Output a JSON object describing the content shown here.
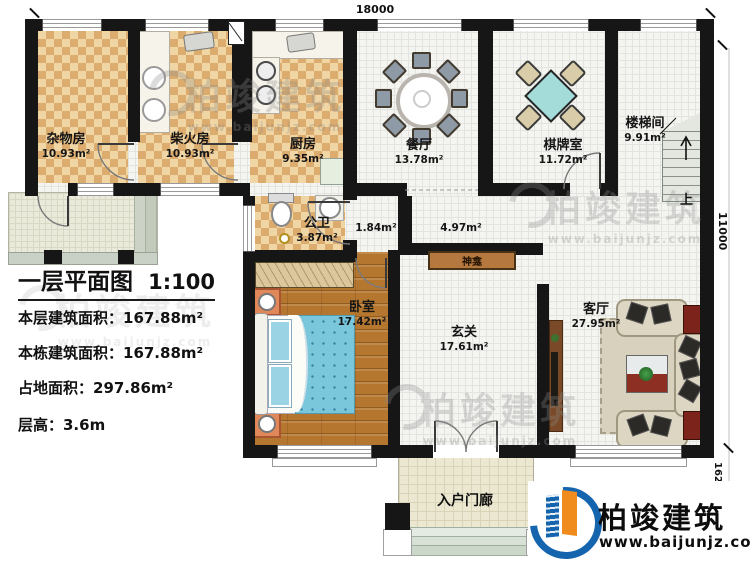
{
  "drawing": {
    "title": "一层平面图",
    "scale": "1:100",
    "info_lines": [
      "本层建筑面积：167.88m²",
      "本栋建筑面积：167.88m²",
      "占地面积：297.86m²",
      "层高：3.6m"
    ]
  },
  "rooms": [
    {
      "name": "杂物房",
      "area": "10.93m²"
    },
    {
      "name": "柴火房",
      "area": "10.93m²"
    },
    {
      "name": "厨房",
      "area": "9.35m²"
    },
    {
      "name": "餐厅",
      "area": "13.78m²"
    },
    {
      "name": "棋牌室",
      "area": "11.72m²"
    },
    {
      "name": "楼梯间",
      "area": "9.91m²"
    },
    {
      "name": "公卫",
      "area": "3.87m²"
    },
    {
      "name": "卧室",
      "area": "17.42m²"
    },
    {
      "name": "玄关",
      "area": "17.61m²"
    },
    {
      "name": "客厅",
      "area": "27.95m²"
    }
  ],
  "zones": {
    "corridor_small": "1.84m²",
    "corridor_large": "4.97m²",
    "shrine": "神龛",
    "porch": "入户门廊",
    "stair_up": "上"
  },
  "dimensions": {
    "top_width": "18000",
    "right_height": "11000",
    "porch_depth": "1620"
  },
  "branding": {
    "company": "柏竣建筑",
    "website": "www.baijunjz.com",
    "watermark_text": "柏竣建筑",
    "watermark_url": "www.baijunjz.com",
    "logo_blue": "#1565ae",
    "logo_orange": "#f08b1e"
  }
}
